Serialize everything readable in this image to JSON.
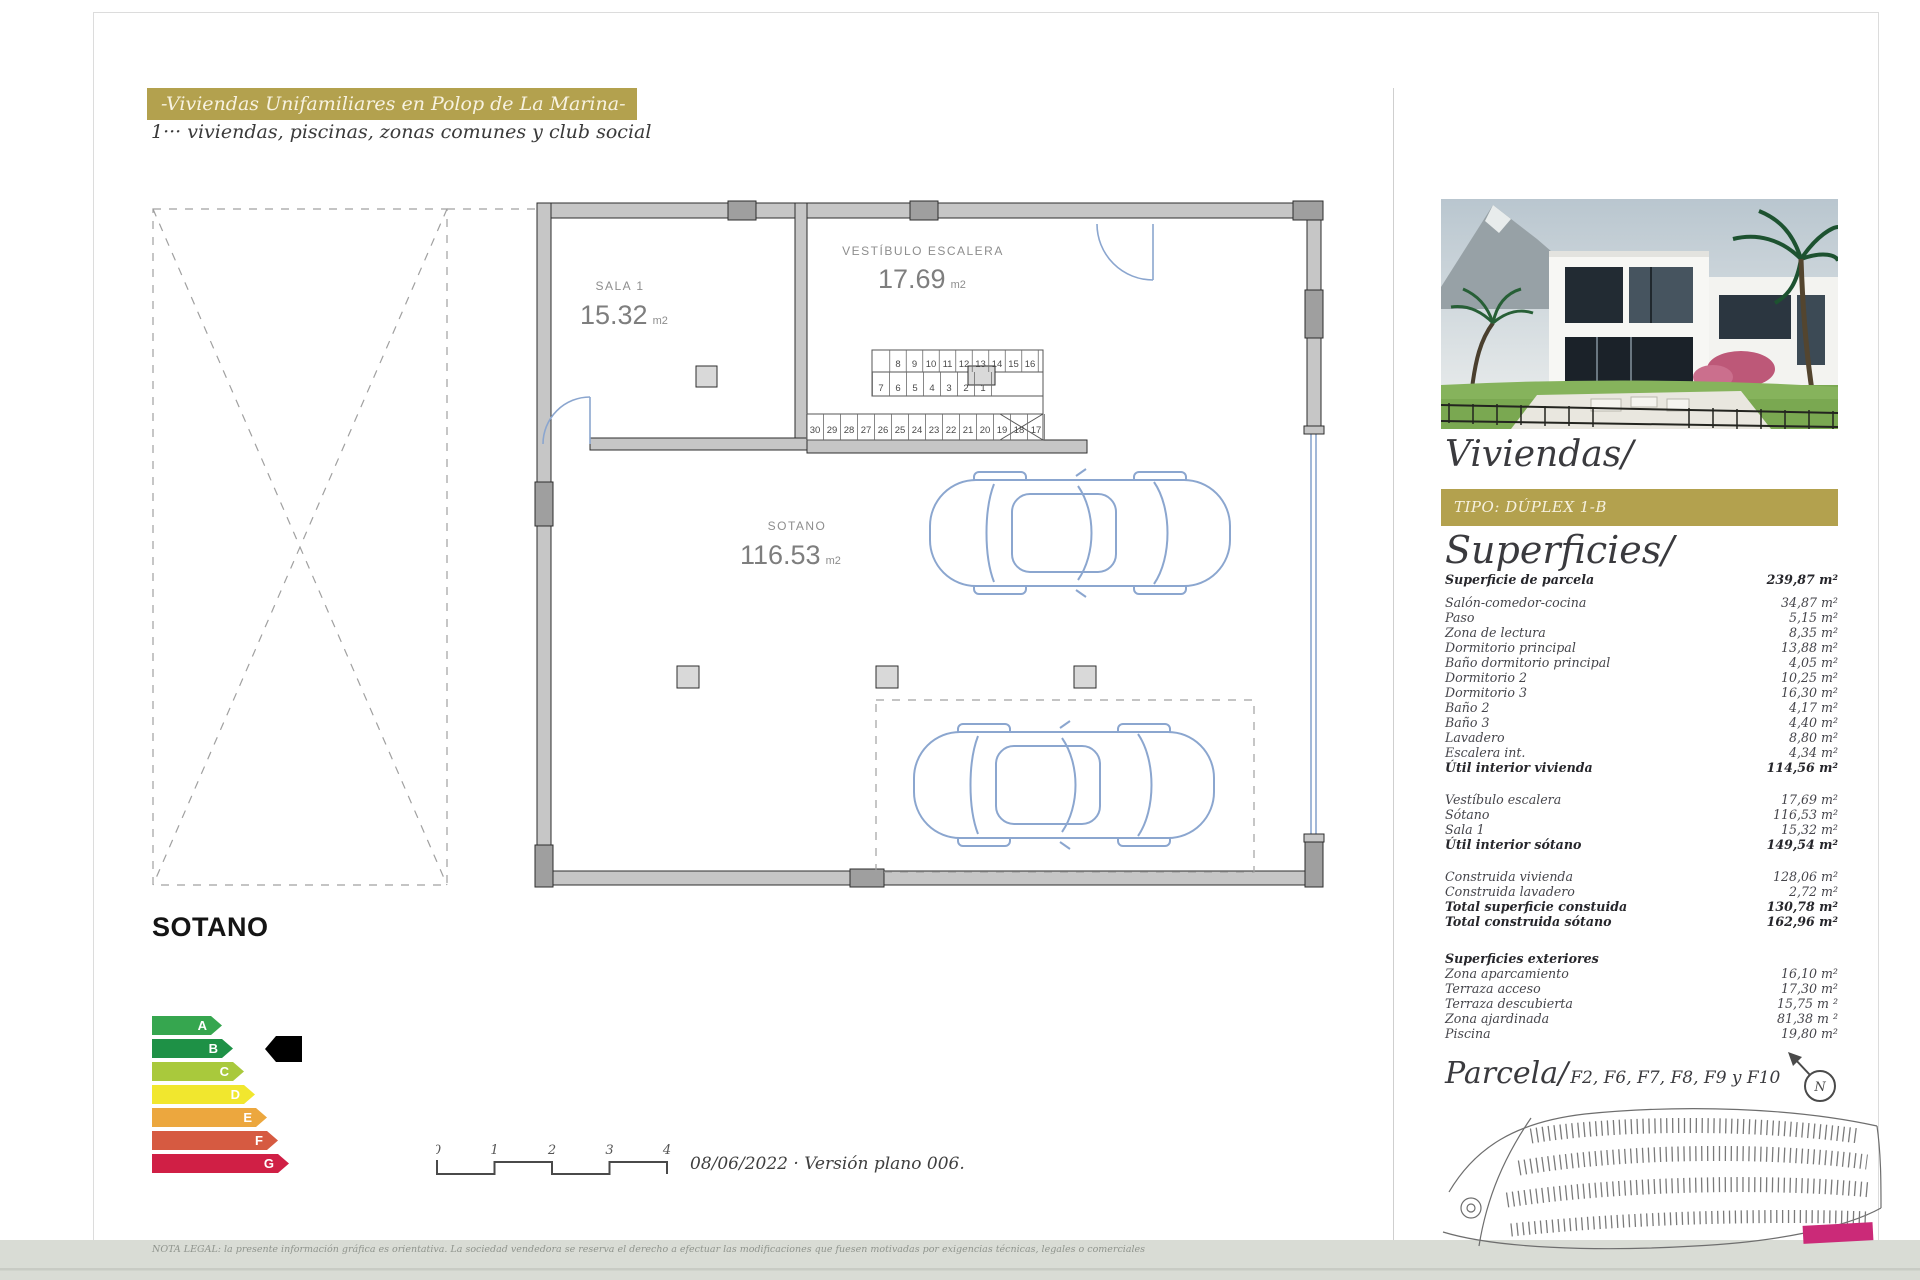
{
  "header": {
    "banner": "-Viviendas Unifamiliares en Polop de La Marina-",
    "subtitle": "1··· viviendas, piscinas, zonas comunes y club social"
  },
  "plan": {
    "rooms": {
      "sala": {
        "name": "SALA 1",
        "area": "15.32",
        "unit": "m2"
      },
      "vestibulo": {
        "name": "VESTÍBULO ESCALERA",
        "area": "17.69",
        "unit": "m2"
      },
      "sotano": {
        "name": "SOTANO",
        "area": "116.53",
        "unit": "m2"
      }
    },
    "stairs": {
      "top": [
        "8",
        "9",
        "10",
        "11",
        "12",
        "13",
        "14",
        "15",
        "16"
      ],
      "mid": [
        "7",
        "6",
        "5",
        "4",
        "3",
        "2",
        "1"
      ],
      "bottom": [
        "30",
        "29",
        "28",
        "27",
        "26",
        "25",
        "24",
        "23",
        "22",
        "21",
        "20",
        "19",
        "18",
        "17"
      ]
    },
    "floor_label": "SOTANO"
  },
  "energy": {
    "ratings": [
      {
        "letter": "A",
        "color": "#36a64f",
        "width": 70
      },
      {
        "letter": "B",
        "color": "#1e9146",
        "width": 81
      },
      {
        "letter": "C",
        "color": "#a9c93c",
        "width": 92
      },
      {
        "letter": "D",
        "color": "#f1e72e",
        "width": 103
      },
      {
        "letter": "E",
        "color": "#eca73e",
        "width": 115
      },
      {
        "letter": "F",
        "color": "#d65a41",
        "width": 126
      },
      {
        "letter": "G",
        "color": "#d01f45",
        "width": 137
      }
    ],
    "indicator_row": "B"
  },
  "scalebar": {
    "ticks": [
      "0",
      "1",
      "2",
      "3",
      "4"
    ],
    "caption": "08/06/2022 · Versión plano 006."
  },
  "legal": "NOTA LEGAL: la presente información gráfica es orientativa. La sociedad vendedora se reserva el derecho a efectuar las modificaciones que fuesen motivadas por exigencias técnicas, legales o comerciales",
  "sidebar": {
    "title": "Viviendas/",
    "type_badge": "TIPO: DÚPLEX 1-B",
    "surfaces_title": "Superficies/",
    "surfaces": [
      {
        "label": "Superficie de parcela",
        "value": "239,87 m²",
        "bold": true
      },
      {
        "label": "Salón-comedor-cocina",
        "value": "34,87 m²",
        "gap": 8
      },
      {
        "label": "Paso",
        "value": "5,15 m²"
      },
      {
        "label": "Zona de lectura",
        "value": "8,35 m²"
      },
      {
        "label": "Dormitorio principal",
        "value": "13,88 m²"
      },
      {
        "label": "Baño dormitorio principal",
        "value": "4,05 m²"
      },
      {
        "label": "Dormitorio 2",
        "value": "10,25 m²"
      },
      {
        "label": "Dormitorio 3",
        "value": "16,30 m²"
      },
      {
        "label": "Baño 2",
        "value": "4,17 m²"
      },
      {
        "label": "Baño 3",
        "value": "4,40 m²"
      },
      {
        "label": "Lavadero",
        "value": "8,80 m²"
      },
      {
        "label": "Escalera int.",
        "value": "4,34 m²"
      },
      {
        "label": "Útil interior vivienda",
        "value": "114,56 m²",
        "bold": true
      },
      {
        "label": "Vestíbulo escalera",
        "value": "17,69 m²",
        "gap": 17
      },
      {
        "label": "Sótano",
        "value": "116,53 m²"
      },
      {
        "label": "Sala 1",
        "value": "15,32 m²"
      },
      {
        "label": "Útil interior sótano",
        "value": "149,54 m²",
        "bold": true
      },
      {
        "label": "Construida vivienda",
        "value": "128,06 m²",
        "gap": 17
      },
      {
        "label": "Construida lavadero",
        "value": "2,72 m²"
      },
      {
        "label": "Total superficie constuida",
        "value": "130,78 m²",
        "bold": true
      },
      {
        "label": "Total construida sótano",
        "value": "162,96 m²",
        "bold": true
      },
      {
        "label": "Superficies exteriores",
        "value": "",
        "bold": true,
        "gap": 22
      },
      {
        "label": "Zona aparcamiento",
        "value": "16,10 m²"
      },
      {
        "label": "Terraza acceso",
        "value": "17,30 m²"
      },
      {
        "label": "Terraza descubierta",
        "value": "15,75 m ²"
      },
      {
        "label": "Zona ajardinada",
        "value": "81,38 m ²"
      },
      {
        "label": "Piscina",
        "value": "19,80 m²"
      }
    ],
    "parcela": {
      "title": "Parcela/",
      "subtitle": "F2, F6, F7, F8, F9 y F10",
      "compass": "N"
    }
  },
  "colors": {
    "gold": "#b3a14e",
    "plan_blue": "#8ba6cf",
    "highlight_magenta": "#cb2a78",
    "strip_gray": "#d9dcd5"
  }
}
